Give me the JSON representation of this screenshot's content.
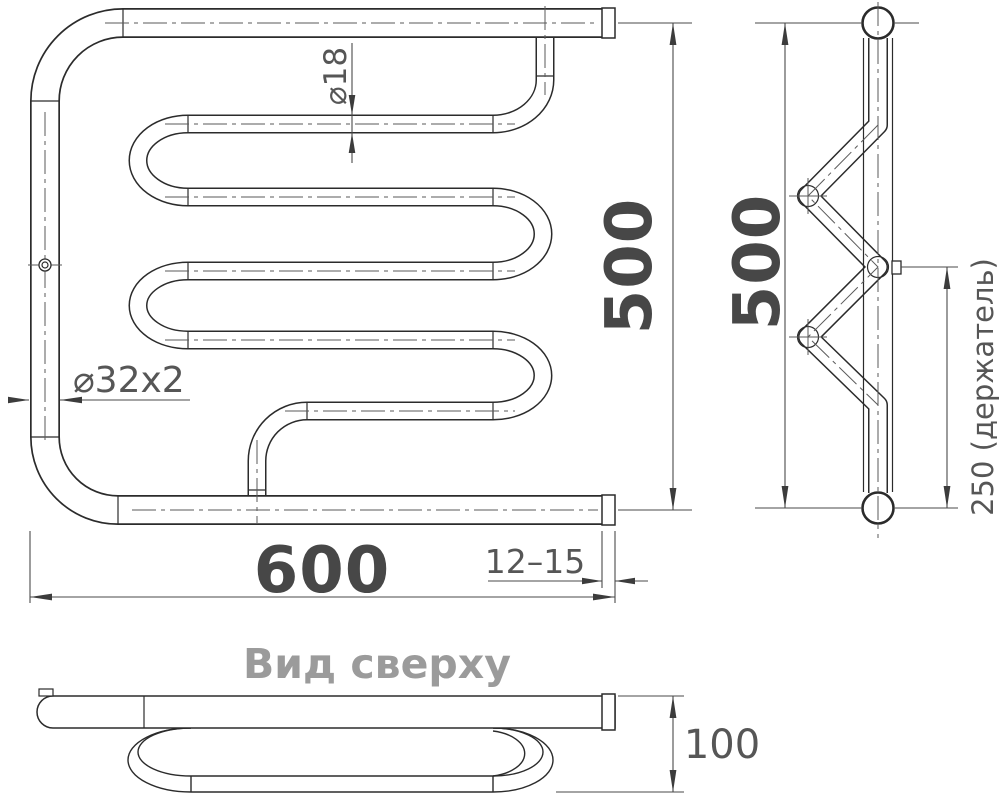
{
  "drawing": {
    "kind": "towel-rail technical drawing",
    "colors": {
      "line": "#2b2b2b",
      "dim_text": "#474747",
      "label_text": "#565656",
      "title_text": "#9b9b9b"
    },
    "front_view": {
      "width_dim": "600",
      "height_dim": "500",
      "coil_tube_dia": "⌀18",
      "main_pipe_dia": "⌀32x2",
      "wall_gap_dim": "12–15"
    },
    "side_view": {
      "height_dim": "500",
      "holder_dim": "250 (держатель)"
    },
    "top_view": {
      "title": "Вид сверху",
      "depth_dim": "100"
    }
  }
}
